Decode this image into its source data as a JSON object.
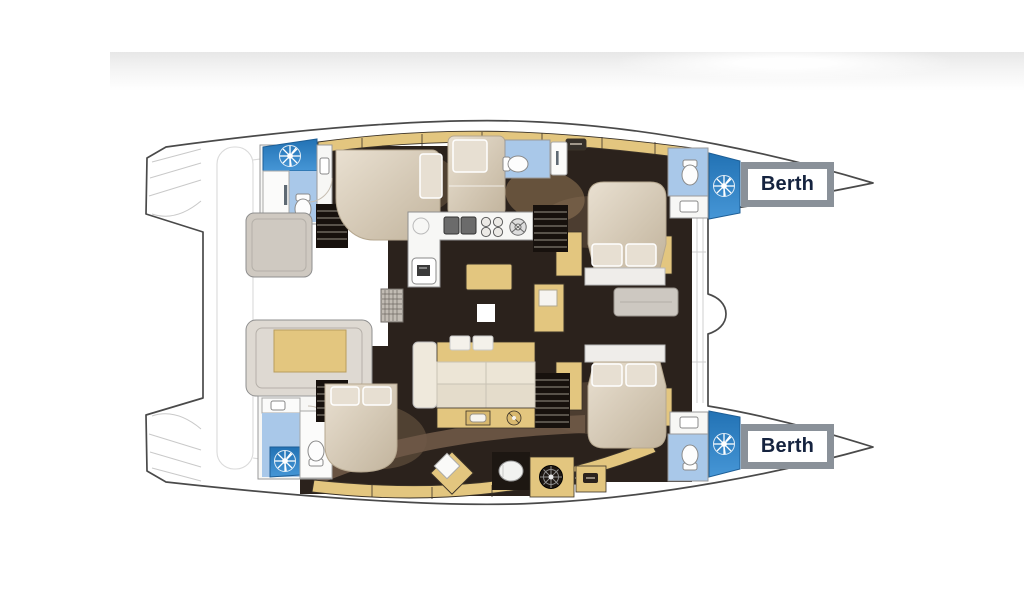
{
  "page": {
    "background_color": "#ffffff",
    "header_band": {
      "color_from": "#e7e7e7",
      "color_to": "#ffffff"
    }
  },
  "floor_plan": {
    "type": "catamaran-deck-plan",
    "orientation": "bow-right",
    "labels": {
      "berth_forward_top": "Berth",
      "berth_forward_bottom": "Berth"
    },
    "colors": {
      "hull_outline": "#4a4a4a",
      "stern_steps": "#c9c9c9",
      "floor_dark": "#2b221c",
      "floor_shadow": "#6f5947",
      "furniture_tan": "#e3c67f",
      "bed_beige": "#cfc2ad",
      "pillow_light": "#e7dfd2",
      "cushion_cream": "#ece5d6",
      "shower_blue": "#2e86c9",
      "bath_light_blue": "#a9c8e9",
      "counter_white": "#f7f7f5",
      "module_taupe": "#cfc9c1",
      "berth_box_border": "#8a9199",
      "berth_text": "#15233f"
    },
    "icons": [
      "shower-rose-icon",
      "toilet-icon",
      "sink-icon",
      "stove-burners-icon",
      "helm-wheel-icon",
      "stairs-icon",
      "vent-grate-icon",
      "hatch-icon"
    ]
  }
}
